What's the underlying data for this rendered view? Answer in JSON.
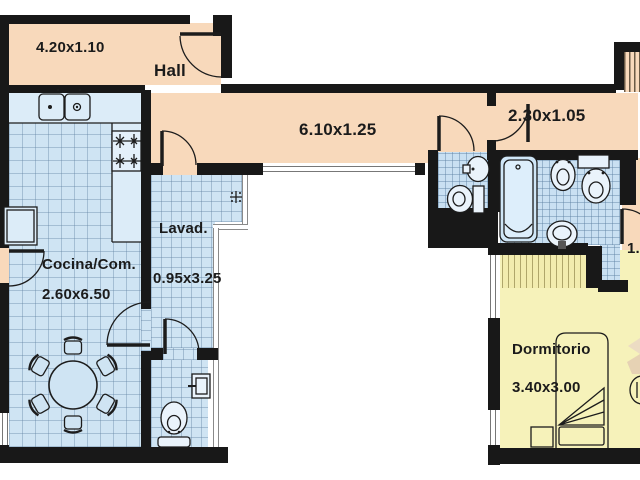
{
  "plan": {
    "title": "apartment-floor-plan",
    "rooms": {
      "hall": {
        "name": "Hall",
        "dims": "4.20x1.10"
      },
      "corridor": {
        "dims": "6.10x1.25"
      },
      "passage": {
        "dims": "2.30x1.05"
      },
      "kitchen": {
        "name": "Cocina/Com.",
        "dims": "2.60x6.50"
      },
      "laundry": {
        "name": "Lavad.",
        "dims": "0.95x3.25"
      },
      "bedroom": {
        "name": "Dormitorio",
        "dims": "3.40x3.00"
      },
      "side_passage": {
        "dims": "1."
      }
    },
    "colors": {
      "wall": "#181818",
      "hall_floor": "#f8d9bb",
      "wet_room_floor": "#cfe4f3",
      "bedroom_floor": "#f6f2ba",
      "outside": "#ffffff"
    },
    "fixtures": [
      "double-sink",
      "stove",
      "fridge",
      "dining-table",
      "chair",
      "bathtub",
      "bidet",
      "toilet",
      "washbasin",
      "shelf",
      "washer-drain",
      "bed",
      "nightstand",
      "wardrobe",
      "desk-chair"
    ]
  }
}
